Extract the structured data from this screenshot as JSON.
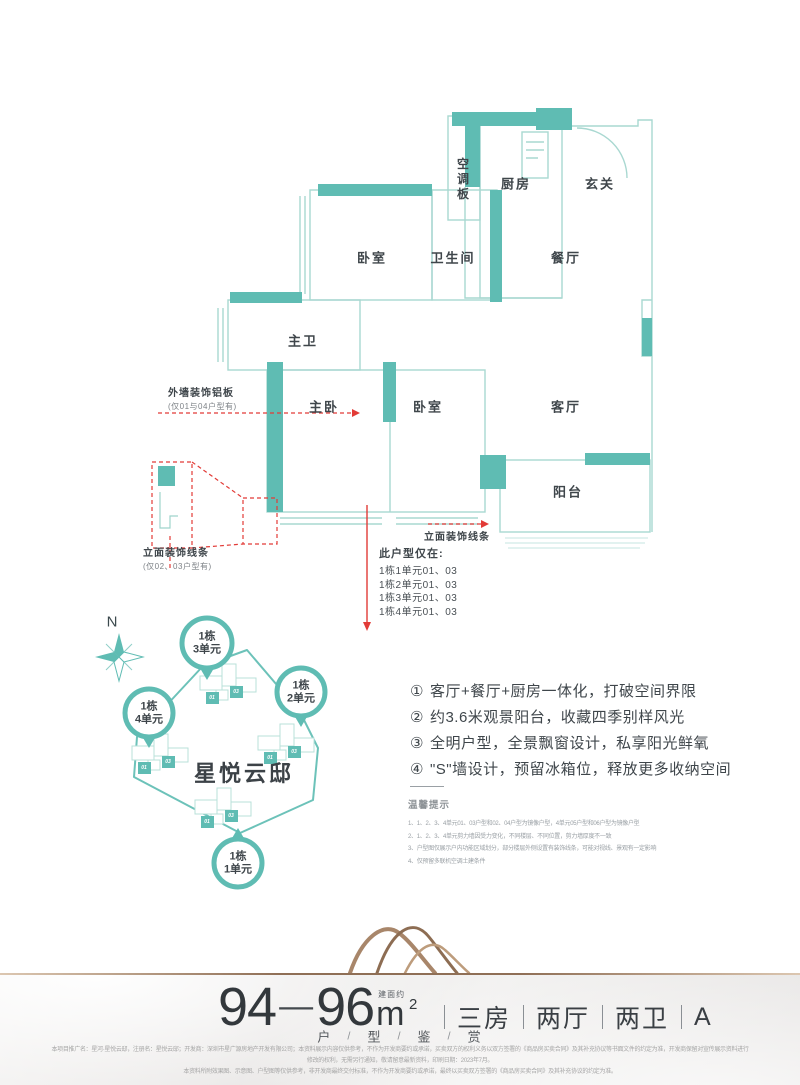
{
  "colors": {
    "accent": "#5fbcb3",
    "outline": "#a9d8d1",
    "red": "#e23b37",
    "bronze": "#8f6f56"
  },
  "floor_plan": {
    "rooms": {
      "ac_board": "空调板",
      "kitchen": "厨房",
      "entry": "玄关",
      "bedroom_top": "卧室",
      "bathroom": "卫生间",
      "dining": "餐厅",
      "master_bath": "主卫",
      "master_bedroom": "主卧",
      "bedroom_bottom": "卧室",
      "living": "客厅",
      "balcony": "阳台"
    },
    "annotations": {
      "wall_panel_label": "外墙装饰铝板",
      "wall_panel_note": "(仅01与04户型有)",
      "facade_left_label": "立面装饰线条",
      "facade_left_note": "(仅02、03户型有)",
      "facade_right_label": "立面装饰线条",
      "availability_title": "此户型仅在:",
      "availability_items": [
        "1栋1单元01、03",
        "1栋2单元01、03",
        "1栋3单元01、03",
        "1栋4单元01、03"
      ]
    }
  },
  "site_plan": {
    "compass_label": "N",
    "project_name": "星悦云邸",
    "pins": [
      {
        "line1": "1栋",
        "line2": "3单元"
      },
      {
        "line1": "1栋",
        "line2": "2单元"
      },
      {
        "line1": "1栋",
        "line2": "4单元"
      },
      {
        "line1": "1栋",
        "line2": "1单元"
      }
    ],
    "unit_01": "01",
    "unit_03": "03"
  },
  "highlights": {
    "items": [
      {
        "num": "①",
        "text": "客厅+餐厅+厨房一体化，打破空间界限"
      },
      {
        "num": "②",
        "text": "约3.6米观景阳台，收藏四季别样风光"
      },
      {
        "num": "③",
        "text": "全明户型，全景飘窗设计，私享阳光鲜氧"
      },
      {
        "num": "④",
        "text": "\"S\"墙设计，预留冰箱位，释放更多收纳空间"
      }
    ]
  },
  "tips": {
    "title": "温馨提示",
    "notes": [
      "1、1、2、3、4单元01、03户型和02、04户型为镜像户型，4单元05户型和06户型为镜像户型",
      "2、1、2、3、4单元剪力墙因受力变化，不同楼层、不同位置，剪力墙厚度不一致",
      "3、户型图仅展示户内功能区域划分，部分楼层外侧设置有装饰线条，可能对视线、景观有一定影响",
      "4、仅预留多联机空调土建条件"
    ]
  },
  "footer": {
    "area_from": "94",
    "area_dash": "—",
    "area_to": "96",
    "area_note": "建面约",
    "area_unit": "m",
    "area_sup": "2",
    "specs": [
      "三房",
      "两厅",
      "两卫",
      "A"
    ],
    "subtitle": [
      "户",
      "型",
      "鉴",
      "赏"
    ],
    "subtitle_sep": "/",
    "legal": [
      "本项目推广名：星河·星悦云邸，注册名：星悦云邸；开发商：深圳市星广源房地产开发有限公司；本资料展示内容仅供参考，不作为开发商要约或承诺，买卖双方的权利义务以双方签署的《商品房买卖合同》及其补充协议等书面文件的约定为准，开发商保留对宣传展示资料进行",
      "修改的权利，无需另行通知，敬请留意最新资料，印刷日期：2023年7月。",
      "本资料所附效果图、示意图、户型图等仅供参考，非开发商最终交付标准，不作为开发商要约或承诺，最终以买卖双方签署的《商品房买卖合同》及其补充协议的约定为准。"
    ]
  }
}
